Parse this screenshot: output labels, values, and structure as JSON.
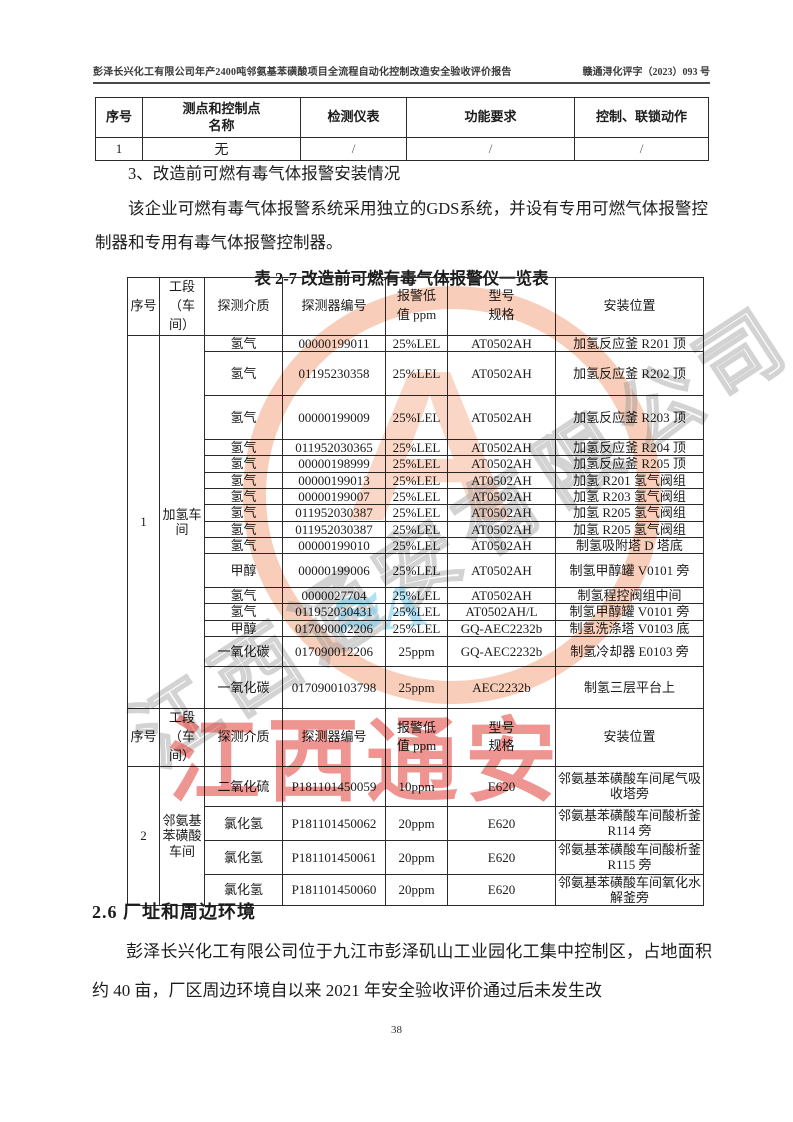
{
  "header": {
    "title": "彭泽长兴化工有限公司年产2400吨邻氨基苯磺酸项目全流程自动化控制改造安全验收评价报告",
    "doc_number": "赣通浔化评字（2023）093 号"
  },
  "table1": {
    "headers": [
      "序号",
      "测点和控制点\n名称",
      "检测仪表",
      "功能要求",
      "控制、联锁动作"
    ],
    "rows": [
      [
        "1",
        "无",
        "/",
        "/",
        "/"
      ]
    ]
  },
  "section3": {
    "heading": "3、改造前可燃有毒气体报警安装情况",
    "paragraph": "该企业可燃有毒气体报警系统采用独立的GDS系统，并设有专用可燃气体报警控制器和专用有毒气体报警控制器。"
  },
  "table2": {
    "caption": "表 2-7  改造前可燃有毒气体报警仪一览表",
    "headers": [
      "序号",
      "工段（车间）",
      "探测介质",
      "探测器编号",
      "报警低\n值 ppm",
      "型号\n规格",
      "安装位置"
    ],
    "sections": [
      {
        "seq": "1",
        "workshop": "加氢车间",
        "rows": [
          [
            "氢气",
            "00000199011",
            "25%LEL",
            "AT0502AH",
            "加氢反应釜 R201 顶"
          ],
          [
            "氢气",
            "01195230358",
            "25%LEL",
            "AT0502AH",
            "加氢反应釜 R202 顶"
          ],
          [
            "氢气",
            "00000199009",
            "25%LEL",
            "AT0502AH",
            "加氢反应釜 R203 顶"
          ],
          [
            "氢气",
            "011952030365",
            "25%LEL",
            "AT0502AH",
            "加氢反应釜 R204 顶"
          ],
          [
            "氢气",
            "00000198999",
            "25%LEL",
            "AT0502AH",
            "加氢反应釜 R205 顶"
          ],
          [
            "氢气",
            "00000199013",
            "25%LEL",
            "AT0502AH",
            "加氢 R201 氢气阀组"
          ],
          [
            "氢气",
            "00000199007",
            "25%LEL",
            "AT0502AH",
            "加氢 R203 氢气阀组"
          ],
          [
            "氢气",
            "011952030387",
            "25%LEL",
            "AT0502AH",
            "加氢 R205 氢气阀组"
          ],
          [
            "氢气",
            "011952030387",
            "25%LEL",
            "AT0502AH",
            "加氢 R205 氢气阀组"
          ],
          [
            "氢气",
            "00000199010",
            "25%LEL",
            "AT0502AH",
            "制氢吸附塔 D 塔底"
          ],
          [
            "甲醇",
            "00000199006",
            "25%LEL",
            "AT0502AH",
            "制氢甲醇罐 V0101 旁"
          ],
          [
            "氢气",
            "0000027704",
            "25%LEL",
            "AT0502AH",
            "制氢程控阀组中间"
          ],
          [
            "氢气",
            "011952030431",
            "25%LEL",
            "AT0502AH/L",
            "制氢甲醇罐 V0101 旁"
          ],
          [
            "甲醇",
            "017090002206",
            "25%LEL",
            "GQ-AEC2232b",
            "制氢洗涤塔 V0103 底"
          ],
          [
            "一氧化碳",
            "017090012206",
            "25ppm",
            "GQ-AEC2232b",
            "制氢冷却器 E0103 旁"
          ],
          [
            "一氧化碳",
            "0170900103798",
            "25ppm",
            "AEC2232b",
            "制氢三层平台上"
          ]
        ]
      },
      {
        "seq": "2",
        "workshop": "邻氨基苯磺酸车间",
        "rows": [
          [
            "二氧化硫",
            "P181101450059",
            "10ppm",
            "E620",
            "邻氨基苯磺酸车间尾气吸收塔旁"
          ],
          [
            "氯化氢",
            "P181101450062",
            "20ppm",
            "E620",
            "邻氨基苯磺酸车间酸析釜 R114 旁"
          ],
          [
            "氯化氢",
            "P181101450061",
            "20ppm",
            "E620",
            "邻氨基苯磺酸车间酸析釜 R115 旁"
          ],
          [
            "氯化氢",
            "P181101450060",
            "20ppm",
            "E620",
            "邻氨基苯磺酸车间氧化水解釜旁"
          ]
        ]
      }
    ]
  },
  "section26": {
    "heading": "2.6 厂址和周边环境",
    "paragraph": "彭泽长兴化工有限公司位于九江市彭泽矶山工业园化工集中控制区，占地面积约 40 亩，厂区周边环境自以来 2021 年安全验收评价通过后未发生改"
  },
  "footer": {
    "page_number": "38"
  },
  "watermark": {
    "red_text": "江西通安",
    "outline_text": "江西通安有限公司",
    "blue_mark": "≋A",
    "stamp_letter": "A",
    "colors": {
      "stamp": "#f29e76",
      "red": "#e23e36",
      "blue": "#7dcdeb",
      "outline": "#919191"
    }
  }
}
